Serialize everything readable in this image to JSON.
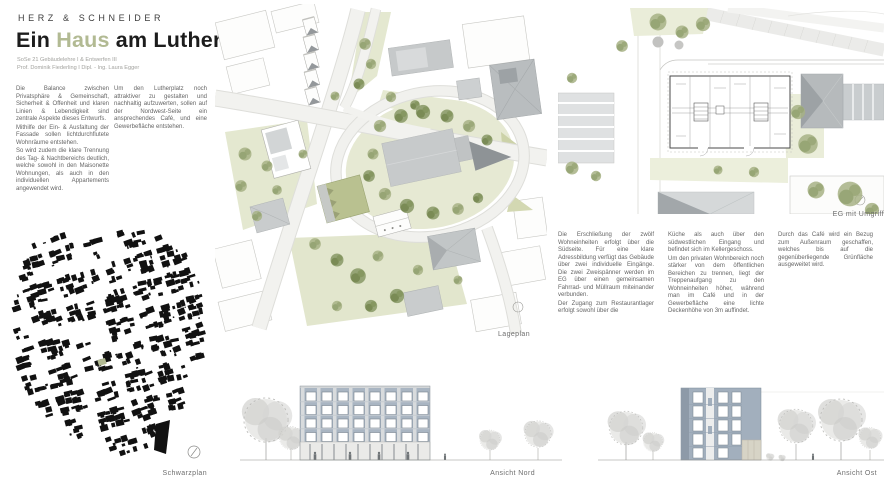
{
  "header": {
    "studio": "HERZ & SCHNEIDER",
    "title_part1": "Ein ",
    "title_accent": "Haus",
    "title_part2": " am Lutherplatz",
    "subtitle_line1": "SoSe 21 Gebäudelehre I & Entwerfen III",
    "subtitle_line2": "Prof. Dominik Fiederling I Dipl. - Ing. Laura Egger"
  },
  "text": {
    "intro_col1": [
      "Die Balance zwischen Privatsphäre & Gemeinschaft, Sicherheit & Offenheit und klaren Linien & Lebendigkeit sind zentrale Aspekte dieses Entwurfs.",
      "Mithilfe der Ein- & Ausfaltung der Fassade sollen lichtdurchflutete Wohnräume entstehen.",
      "So wird zudem die klare Trennung des Tag- & Nachtbereichs deutlich, welche sowohl in den Maisonette Wohnungen, als auch in den individuellen Appartements angewendet wird."
    ],
    "intro_col2": [
      "Um den Lutherplatz noch attraktiver zu gestalten und nachhaltig aufzuwerten, sollen auf der Nordwest-Seite ein ansprechendes Café, und eine Gewerbefläche entstehen."
    ],
    "desc_col1": [
      "Die Erschließung der zwölf Wohneinheiten erfolgt über die Südseite. Für eine klare Adressbildung verfügt das Gebäude über zwei individuelle Eingänge. Die zwei Zweispänner werden im EG über einen gemeinsamen Fahrrad- und Müllraum miteinander verbunden.",
      "Der Zugang zum Restaurantlager erfolgt sowohl über die"
    ],
    "desc_col2": [
      "Küche als auch über den südwestlichen Eingang und befindet sich im Kellergeschoss.",
      "Um den privaten Wohnbereich noch stärker von dem öffentlichen Bereichen zu trennen, liegt der Treppenaufgang zu den Wohneinheiten höher, während man im Café und in der Gewerbefläche eine lichte Deckenhöhe von 3m auffindet."
    ],
    "desc_col3": [
      "Durch das Café wird ein Bezug zum Außenraum geschaffen, welches bis auf die gegenüberliegende Grünfläche ausgeweitet wird."
    ]
  },
  "labels": {
    "siteplan": "Lageplan",
    "floorplan": "EG mit Umgriff",
    "figure_ground": "Schwarzplan",
    "elevation_north": "Ansicht Nord",
    "elevation_east": "Ansicht Ost"
  },
  "figures": {
    "siteplan": "site plan of Lutherplatz with oval square, church and surrounding blocks",
    "floorplan": "ground floor plan with context buildings and trees",
    "figure_ground": "black figure-ground city map with highlighted site and north arrow",
    "elevation_north": "north elevation, five storeys, blue-grey facade, trees",
    "elevation_east": "east elevation, narrow facade with window strips, trees"
  },
  "colors": {
    "accent_olive": "#b2ba93",
    "site_green_light": "#e5e8d2",
    "tree_sage": "#a7b185",
    "tree_sage_dark": "#7f9058",
    "roof_gray": "#c6c9ca",
    "roof_dark": "#8e9396",
    "facade_blue": "#a8b4c1",
    "facade_blue_dark": "#8d9aa8",
    "ink": "#1c1c1c",
    "body_text": "#656565",
    "map_black": "#111111"
  }
}
